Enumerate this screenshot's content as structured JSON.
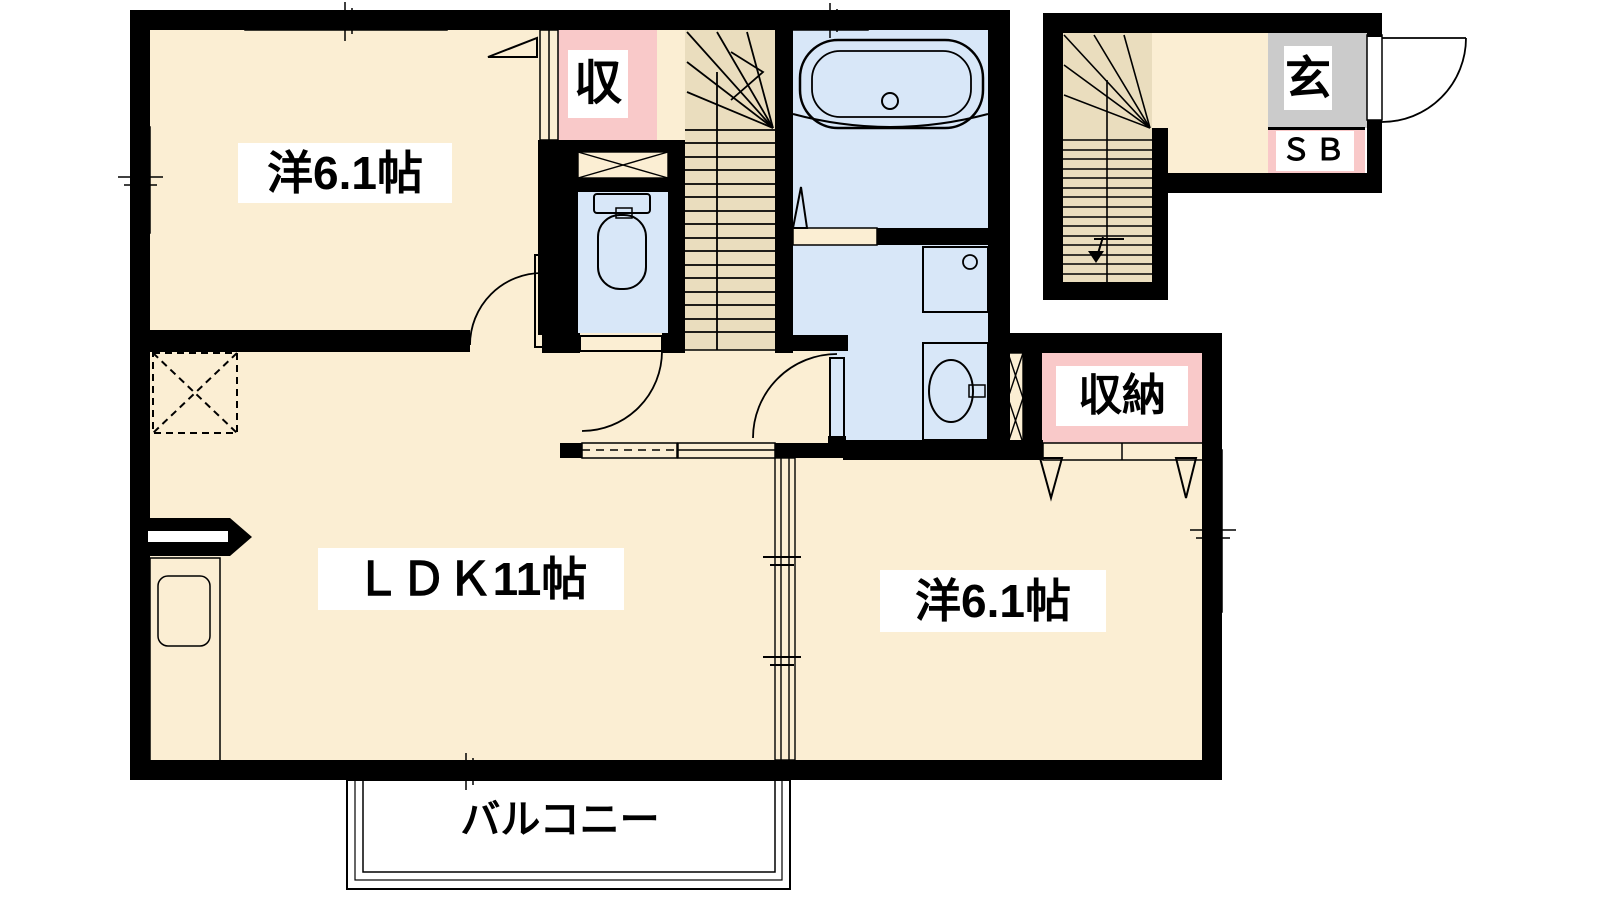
{
  "meta": {
    "type": "floorplan",
    "description": "Japanese apartment floor plan, 2nd-floor 2LDK unit with balcony and external entrance staircase"
  },
  "labels": {
    "room1": "洋6.1帖",
    "ldk": "ＬＤＫ11帖",
    "bedroom2": "洋6.1帖",
    "closet1": "収",
    "closet2": "収納",
    "entrance": "玄",
    "shoebox": "ＳＢ",
    "balcony": "バルコニー"
  },
  "rooms": [
    {
      "name": "western-room-1",
      "label": "洋6.1帖",
      "position": "top-left"
    },
    {
      "name": "ldk",
      "label": "ＬＤＫ11帖",
      "position": "center-left"
    },
    {
      "name": "western-room-2",
      "label": "洋6.1帖",
      "position": "bottom-right"
    },
    {
      "name": "bathroom",
      "fixture": "bathtub",
      "position": "top-center"
    },
    {
      "name": "washroom",
      "fixtures": [
        "washing-machine",
        "wash-basin"
      ],
      "position": "center"
    },
    {
      "name": "toilet",
      "fixture": "toilet",
      "position": "center-left-of-stairs"
    },
    {
      "name": "closet-shu",
      "label": "収",
      "position": "top-center"
    },
    {
      "name": "storage-shuno",
      "label": "収納",
      "position": "center-right"
    },
    {
      "name": "entrance-hall",
      "labels": [
        "玄",
        "ＳＢ"
      ],
      "position": "top-right"
    },
    {
      "name": "balcony",
      "label": "バルコニー",
      "position": "bottom"
    }
  ],
  "fixtures": [
    "bathtub",
    "washing-machine",
    "wash-basin",
    "toilet",
    "kitchen-sink",
    "refrigerator-space",
    "main-staircase",
    "entrance-staircase"
  ],
  "colors": {
    "room_floor": "#FBEED3",
    "stairs": "#EADDBE",
    "wet_area": "#D8E7F8",
    "storage_pink": "#F9C9C9",
    "kitchen_counter": "#E9E1F4",
    "entrance_tile": "#CBCBCB",
    "balcony": "#D2D2D2",
    "wall": "#000000",
    "background": "#FFFFFF"
  }
}
